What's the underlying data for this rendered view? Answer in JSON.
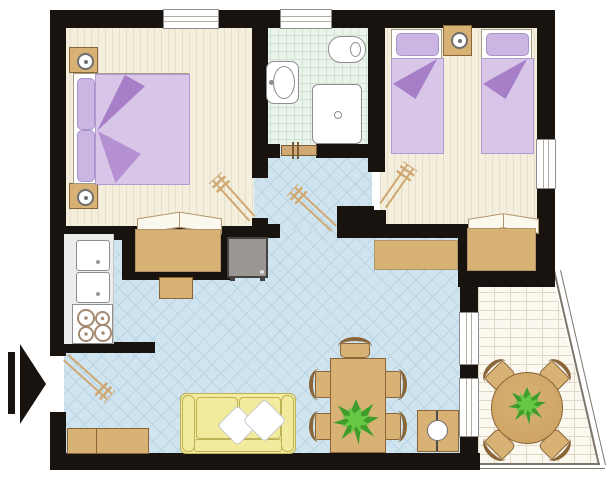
{
  "title": "Apartment floor plan (top-down 2D plan, no text labels)",
  "palette": {
    "wall": "#191310",
    "line": "#7d766a",
    "floor_cream": "#f4efdc",
    "floor_cream_stripe": "#e5deca",
    "floor_bath": "#eaf4eb",
    "floor_bath_line": "#cfe2d4",
    "floor_blue": "#cfe4ef",
    "floor_blue_line": "#b9d4e2",
    "floor_terrace": "#faf8ef",
    "floor_terrace_line": "#ded8c5",
    "counter": "#ececea",
    "wood": "#d8b175",
    "wood_dark": "#8a6538",
    "door_wood": "#cfa873",
    "purple_light": "#d8c6e9",
    "purple_pillow": "#cbb6e3",
    "purple_dark": "#a67fc8",
    "purple_mid": "#b590d3",
    "sofa_yellow": "#f2eb9d",
    "sofa_line": "#bdb257",
    "tv_gray": "#9a9792",
    "tv_dark": "#45423f",
    "leaf_dark": "#3f9e2b",
    "leaf_light": "#66c844",
    "fixture_line": "#8e8e8e"
  },
  "legend": {
    "rooms": [
      {
        "name": "double-bedroom",
        "position": "top-left",
        "floor": "cream-striped-parquet",
        "furniture": [
          "double-bed-purple-linen",
          "nightstand-with-lamp",
          "nightstand-with-lamp",
          "dressing-table-in-niche",
          "stool"
        ],
        "windows": 1
      },
      {
        "name": "bathroom",
        "position": "top-center",
        "floor": "pale-green-tiles",
        "furniture": [
          "toilet",
          "washbasin",
          "shower-cabin"
        ],
        "windows": 1
      },
      {
        "name": "twin-bedroom",
        "position": "top-right",
        "floor": "cream-striped-parquet",
        "furniture": [
          "single-bed-purple-linen",
          "single-bed-purple-linen",
          "nightstand-with-lamp",
          "dresser-in-niche"
        ],
        "windows": 1
      },
      {
        "name": "hallway",
        "position": "center",
        "floor": "blue-diamond-tiles",
        "furniture": [],
        "windows": 0
      },
      {
        "name": "living-room-with-kitchen",
        "position": "bottom",
        "floor": "blue-diamond-tiles",
        "furniture": [
          "kitchen-counter",
          "double-sink-unit",
          "stove-4-burners",
          "tv-set",
          "sideboard",
          "entry-bench",
          "yellow-sofa-two-white-cushions",
          "dining-table-with-plant",
          "dining-chair",
          "dining-chair",
          "dining-chair",
          "dining-chair",
          "dining-chair",
          "side-table-with-lamp"
        ],
        "windows": 2
      },
      {
        "name": "terrace",
        "position": "bottom-right-angled",
        "floor": "pale-brick-tiles",
        "furniture": [
          "round-table-with-plant",
          "chair",
          "chair",
          "chair",
          "chair"
        ],
        "windows": 0
      }
    ],
    "doors": [
      "entrance-door-left-wall",
      "double-bedroom-door",
      "bathroom-door",
      "hallway-living-door",
      "twin-bedroom-door"
    ],
    "markers": [
      "black-entrance-arrow-pointing-right"
    ]
  }
}
